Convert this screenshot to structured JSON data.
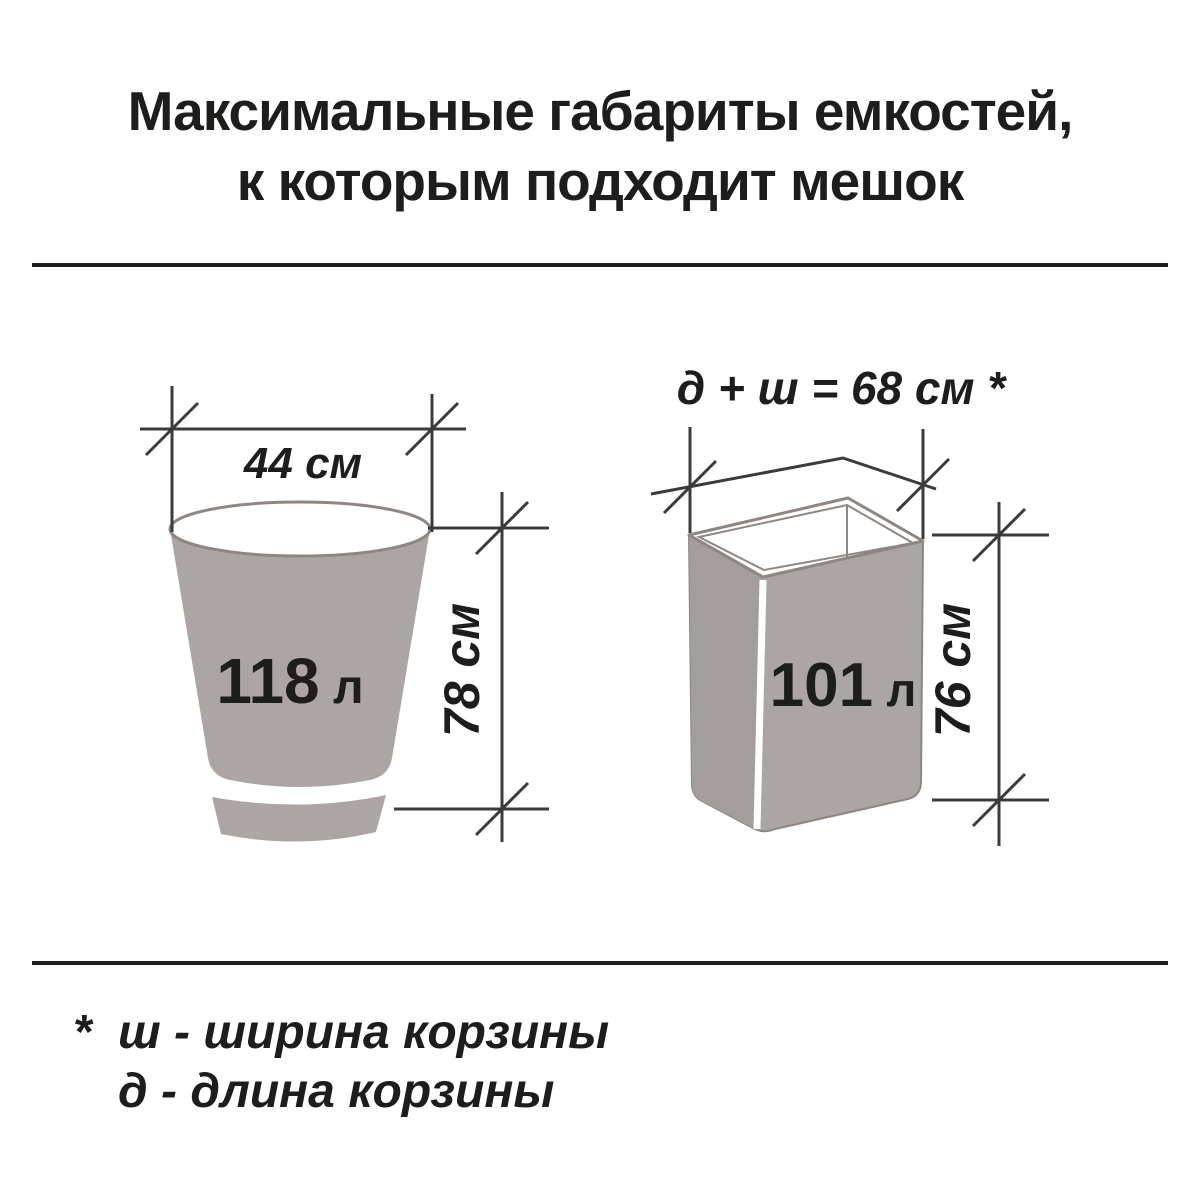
{
  "title": {
    "line1": "Максимальные габариты емкостей,",
    "line2": "к которым подходит мешок"
  },
  "bucket": {
    "volume_value": "118",
    "volume_unit": "л",
    "width_label": "44 см",
    "height_label": "78 см"
  },
  "basket": {
    "volume_value": "101",
    "volume_unit": "л",
    "formula_label": "д + ш = 68 см *",
    "height_label": "76 см"
  },
  "footnote": {
    "marker": "*",
    "line1": "ш - ширина корзины",
    "line2": "д - длина корзины"
  },
  "colors": {
    "container_fill": "#aba5a3",
    "container_fill_dark": "#a39d9b",
    "outline": "#8d8683",
    "dimension_line": "#3b3b3a",
    "ink": "#1d1d1b",
    "bg": "#ffffff"
  }
}
